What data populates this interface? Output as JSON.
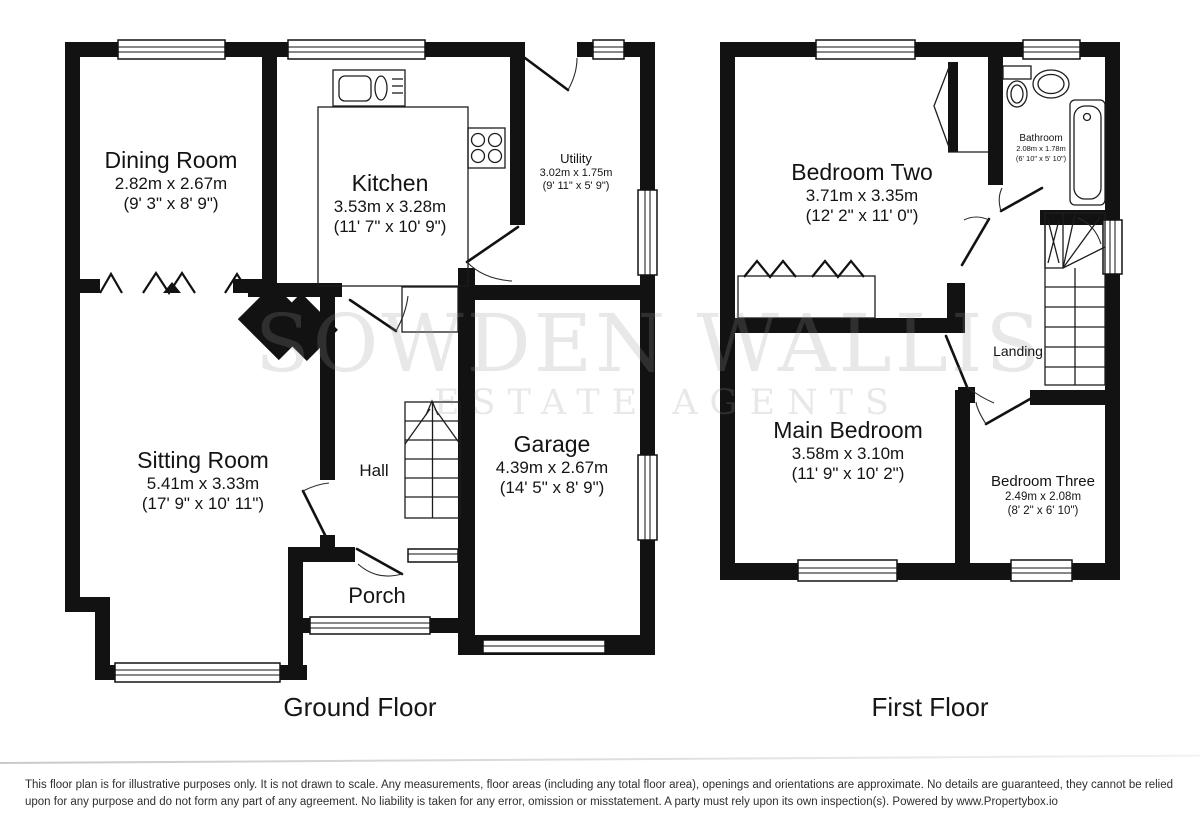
{
  "ground_floor": {
    "title": "Ground Floor",
    "rooms": {
      "dining_room": {
        "name": "Dining Room",
        "metric": "2.82m x 2.67m",
        "imperial": "(9' 3\" x 8' 9\")"
      },
      "kitchen": {
        "name": "Kitchen",
        "metric": "3.53m x 3.28m",
        "imperial": "(11' 7\" x 10' 9\")"
      },
      "utility": {
        "name": "Utility",
        "metric": "3.02m x 1.75m",
        "imperial": "(9' 11\" x 5' 9\")"
      },
      "sitting_room": {
        "name": "Sitting Room",
        "metric": "5.41m x 3.33m",
        "imperial": "(17' 9\" x 10' 11\")"
      },
      "hall": {
        "name": "Hall"
      },
      "porch": {
        "name": "Porch"
      },
      "garage": {
        "name": "Garage",
        "metric": "4.39m x 2.67m",
        "imperial": "(14' 5\" x 8' 9\")"
      }
    }
  },
  "first_floor": {
    "title": "First Floor",
    "rooms": {
      "bedroom_two": {
        "name": "Bedroom Two",
        "metric": "3.71m x 3.35m",
        "imperial": "(12' 2\" x 11' 0\")"
      },
      "bathroom": {
        "name": "Bathroom",
        "metric": "2.08m x 1.78m",
        "imperial": "(6' 10\" x 5' 10\")"
      },
      "landing": {
        "name": "Landing"
      },
      "main_bedroom": {
        "name": "Main Bedroom",
        "metric": "3.58m x 3.10m",
        "imperial": "(11' 9\" x 10' 2\")"
      },
      "bedroom_three": {
        "name": "Bedroom Three",
        "metric": "2.49m x 2.08m",
        "imperial": "(8' 2\" x 6' 10\")"
      }
    }
  },
  "watermark": {
    "name": "SOWDEN WALLIS",
    "tagline": "ESTATE AGENTS"
  },
  "disclaimer": "This floor plan is for illustrative purposes only. It is not drawn to scale. Any measurements, floor areas (including any total floor area), openings and orientations are approximate. No details are guaranteed, they cannot be relied upon for any purpose and do not form any part of any agreement. No liability is taken for any error, omission or misstatement. A party must rely upon its own inspection(s). Powered by www.Propertybox.io",
  "colors": {
    "wall": "#121212",
    "background": "#ffffff",
    "watermark": "#ebebeb",
    "disclaimer_text": "#2e2e2e"
  }
}
